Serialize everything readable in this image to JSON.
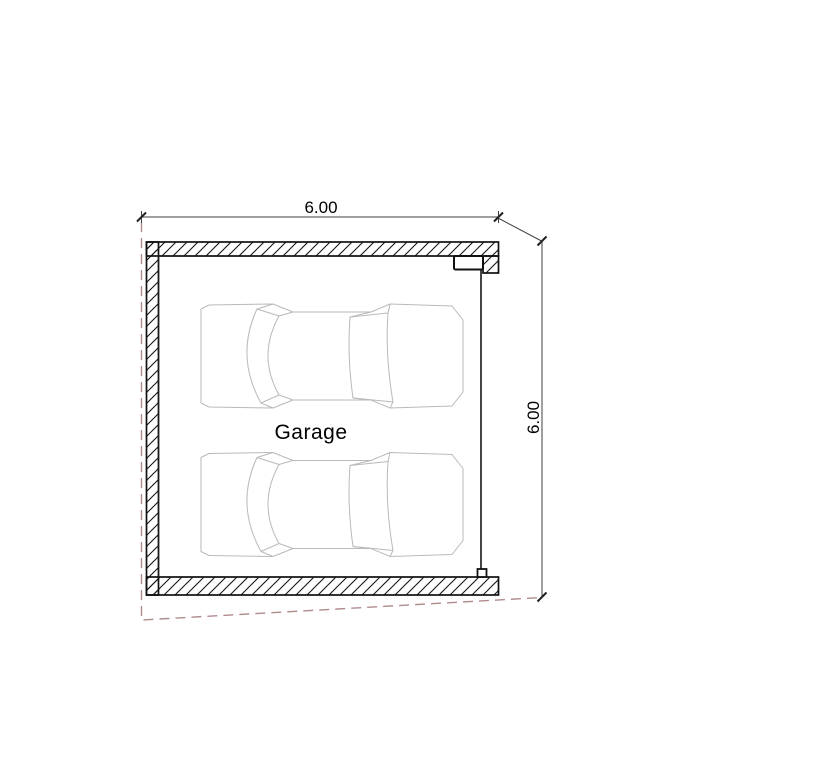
{
  "floorplan": {
    "room_label": "Garage",
    "dimensions": {
      "width": {
        "value": "6.00",
        "orientation": "horizontal",
        "position": "top"
      },
      "height": {
        "value": "6.00",
        "orientation": "vertical",
        "position": "right"
      }
    },
    "objects": {
      "car_count": 2,
      "car_view": "top-view-outline"
    },
    "opening": {
      "side": "right",
      "type": "garage-door"
    }
  },
  "colors": {
    "wall_line": "#111111",
    "inner_line": "#1a1a1a",
    "car_line": "#b9b9b9",
    "dim_line": "#404040",
    "boundary_dash": "#b08b8e",
    "label_text": "#000000",
    "page_bg": "#ffffff"
  }
}
